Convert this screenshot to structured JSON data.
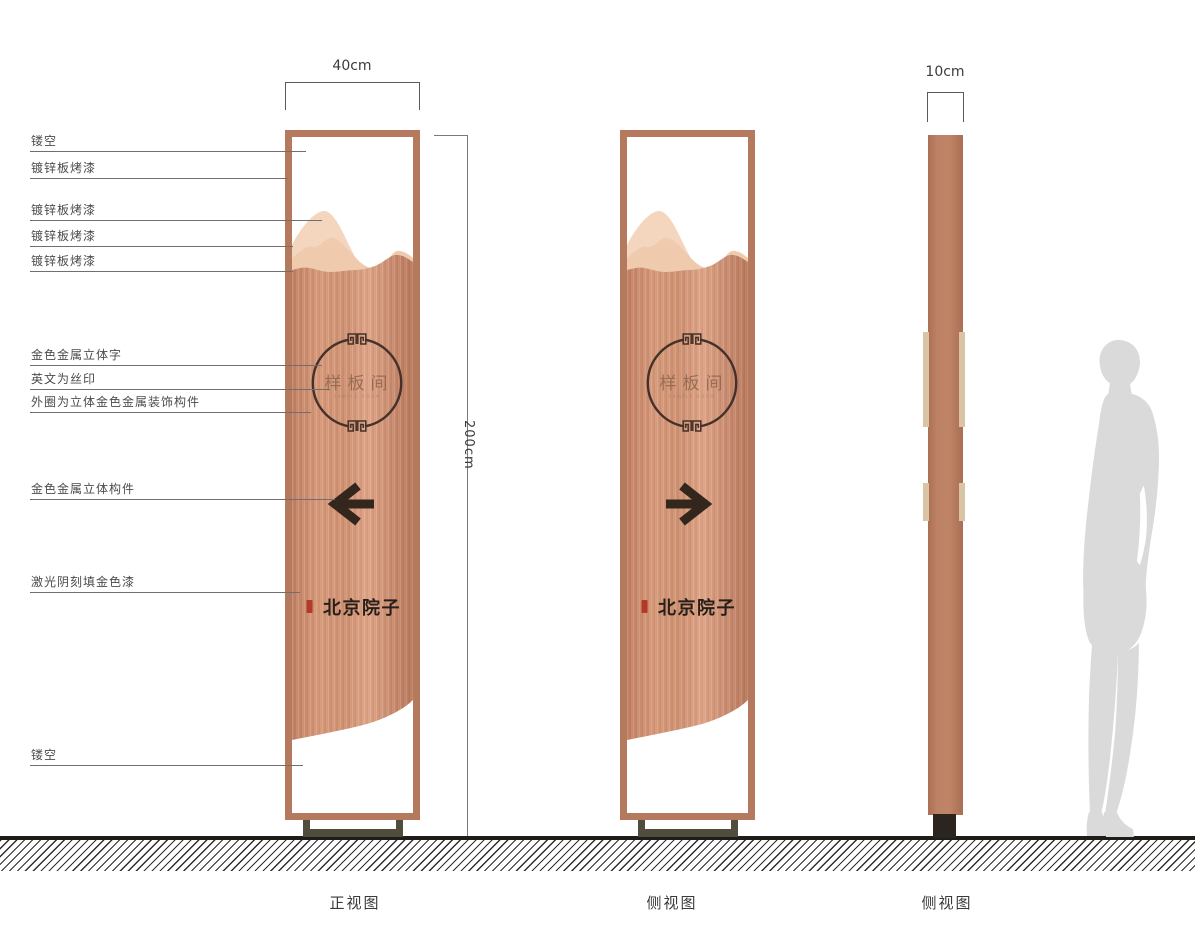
{
  "drawing": {
    "dim_front_width": "40cm",
    "dim_height": "200cm",
    "dim_side_width": "10cm",
    "captions": [
      "正视图",
      "侧视图",
      "侧视图"
    ],
    "annotations_left": [
      "镂空",
      "镀锌板烤漆",
      "镀锌板烤漆",
      "镀锌板烤漆",
      "镀锌板烤漆",
      "金色金属立体字",
      "英文为丝印",
      "外圈为立体金色金属装饰构件",
      "金色金属立体构件",
      "激光阴刻填金色漆",
      "镂空"
    ],
    "sign": {
      "room_label": "样板间",
      "room_label_en": "SAMPLE ROOM",
      "brand_calligraphy": "北京院子",
      "front_arrow_direction": "left",
      "back_arrow_direction": "right"
    },
    "colors": {
      "copper_frame": "#b57a5e",
      "copper_body": "#cf9172",
      "mountain_light": "#f4d6bf",
      "mountain_mid": "#ecc2a4",
      "gold_fitting": "#d9c5a6",
      "ink": "#33261c",
      "engraved_text": "#8a624a",
      "seal_red": "#b23a28",
      "silhouette_gray": "#dadada",
      "base_olive": "#514d3c",
      "base_dark": "#2c241e"
    }
  }
}
